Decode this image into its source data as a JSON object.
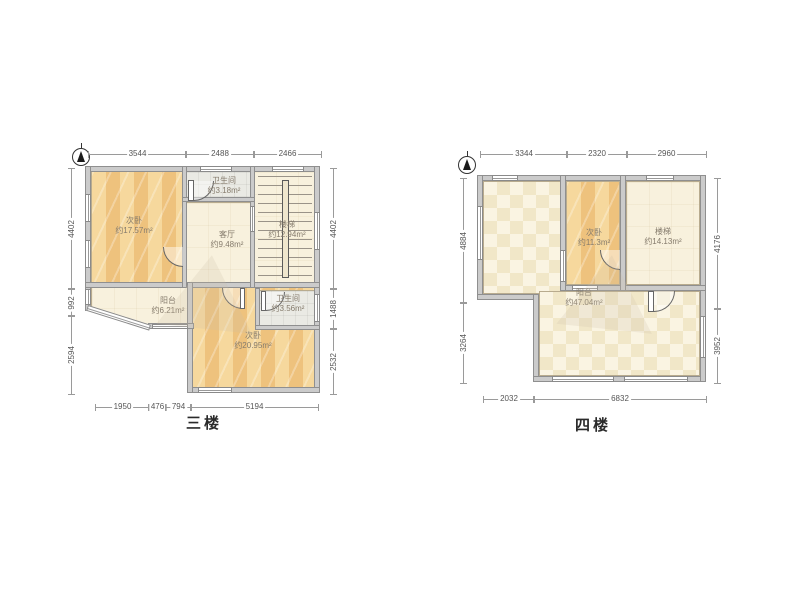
{
  "plans": [
    {
      "title": "三楼",
      "dims": {
        "top": [
          "3544",
          "2488",
          "2466"
        ],
        "left": [
          "4402",
          "992",
          "2594"
        ],
        "right": [
          "4402",
          "1488",
          "2532"
        ],
        "bottom": [
          "1950",
          "476",
          "794",
          "5194"
        ]
      },
      "rooms": [
        {
          "name": "次卧",
          "area": "约17.57m²"
        },
        {
          "name": "卫生间",
          "area": "约3.18m²"
        },
        {
          "name": "客厅",
          "area": "约9.48m²"
        },
        {
          "name": "楼梯",
          "area": "约12.94m²"
        },
        {
          "name": "阳台",
          "area": "约6.21m²"
        },
        {
          "name": "次卧",
          "area": "约20.95m²"
        },
        {
          "name": "卫生间",
          "area": "约3.56m²"
        }
      ]
    },
    {
      "title": "四楼",
      "dims": {
        "top": [
          "3344",
          "2320",
          "2960"
        ],
        "left": [
          "4884",
          "3264"
        ],
        "right": [
          "4176",
          "3952"
        ],
        "bottom": [
          "2032",
          "6832"
        ]
      },
      "rooms": [
        {
          "name": "次卧",
          "area": "约11.3m²"
        },
        {
          "name": "楼梯",
          "area": "约14.13m²"
        },
        {
          "name": "阳台",
          "area": "约47.04m²"
        }
      ]
    }
  ],
  "colors": {
    "wall": "#cbcbcb",
    "wood_floor": "#eec27d",
    "tile_floor": "#eaeae4",
    "plain_floor": "#f8f1dd",
    "checker_floor": "#f1e7c8",
    "dimension_text": "#555555",
    "room_label_text": "#857b6c"
  }
}
